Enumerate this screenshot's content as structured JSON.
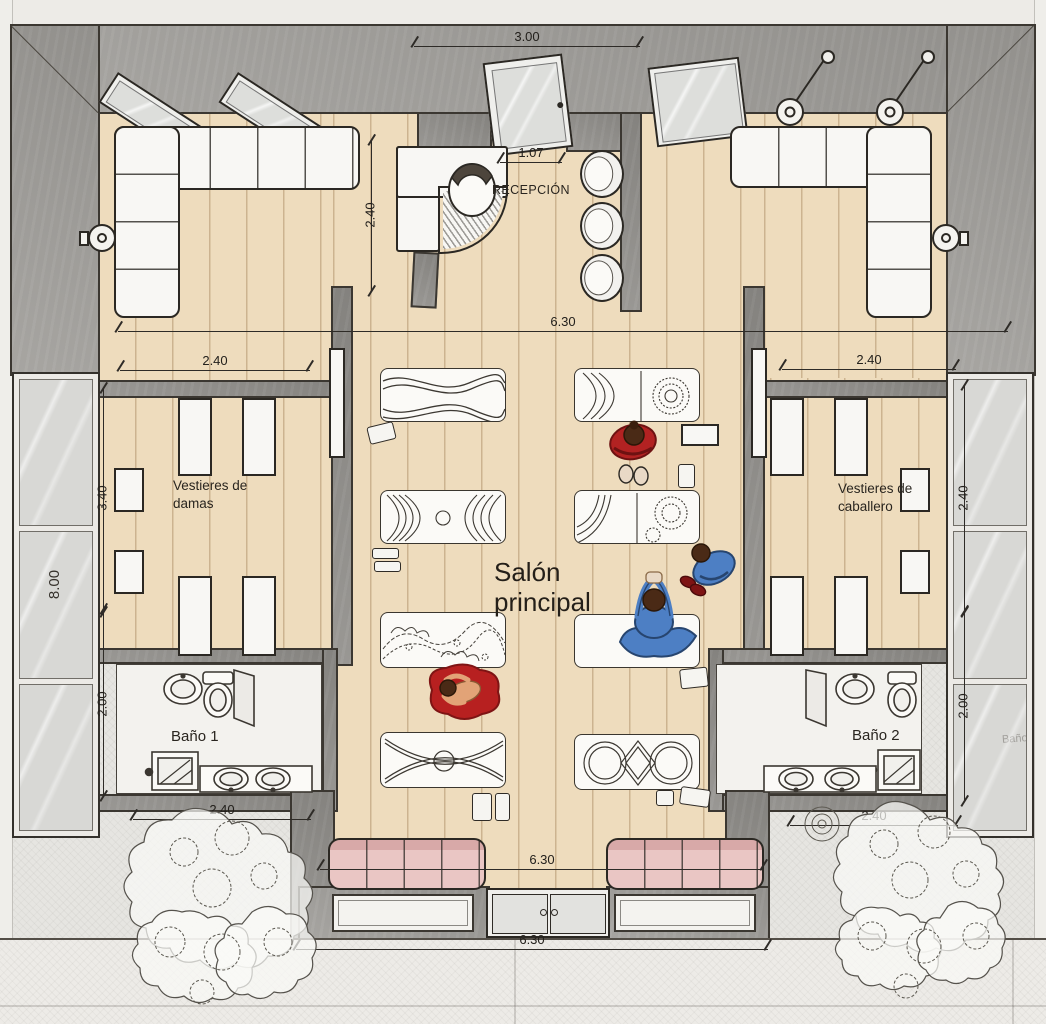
{
  "drawing": {
    "type": "architectural floor plan, top view (yoga / spa studio)",
    "labels": {
      "reception": "RECEPCIÓN",
      "main_hall": "Salón principal",
      "dressing_women": "Vestieres de damas",
      "dressing_men": "Vestieres de caballero",
      "bath_1": "Baño 1",
      "bath_2": "Baño 2",
      "glass_reflection": "Baño"
    },
    "dimensions": [
      {
        "id": "top-entrance-width",
        "value": "3.00",
        "orientation": "horizontal"
      },
      {
        "id": "reception-opening",
        "value": "1.07",
        "orientation": "horizontal"
      },
      {
        "id": "reception-depth",
        "value": "2.40",
        "orientation": "vertical"
      },
      {
        "id": "hall-width-upper",
        "value": "6.30",
        "orientation": "horizontal"
      },
      {
        "id": "dressing-women-width",
        "value": "2.40",
        "orientation": "horizontal"
      },
      {
        "id": "dressing-men-width",
        "value": "2.40",
        "orientation": "horizontal"
      },
      {
        "id": "left-wing-depth",
        "value": "3.40",
        "orientation": "vertical"
      },
      {
        "id": "glass-wall-length",
        "value": "8.00",
        "orientation": "vertical"
      },
      {
        "id": "bath1-depth",
        "value": "2.00",
        "orientation": "vertical"
      },
      {
        "id": "right-wing-depth",
        "value": "2.40",
        "orientation": "vertical"
      },
      {
        "id": "bath2-depth",
        "value": "2.00",
        "orientation": "vertical"
      },
      {
        "id": "bath1-width",
        "value": "2.40",
        "orientation": "horizontal"
      },
      {
        "id": "bath2-width",
        "value": "2.40",
        "orientation": "horizontal"
      },
      {
        "id": "hall-width-lower",
        "value": "6.30",
        "orientation": "horizontal"
      },
      {
        "id": "terrace-width",
        "value": "6.30",
        "orientation": "horizontal"
      }
    ],
    "figures": [
      {
        "pose": "standing arms crossed",
        "outfit": "red",
        "location": "main hall upper right"
      },
      {
        "pose": "kneeling",
        "outfit": "blue",
        "location": "main hall right"
      },
      {
        "pose": "seated arms overhead",
        "outfit": "blue",
        "location": "main hall center on white mat"
      },
      {
        "pose": "lying on round mat",
        "outfit": "red mat",
        "location": "main hall lower left"
      },
      {
        "pose": "seated at desk",
        "outfit": "white",
        "location": "reception"
      }
    ],
    "mats": [
      {
        "col": 1,
        "row": 1,
        "pattern": "waves"
      },
      {
        "col": 1,
        "row": 2,
        "pattern": "feather-chevron"
      },
      {
        "col": 1,
        "row": 3,
        "pattern": "floral-sketch"
      },
      {
        "col": 1,
        "row": 4,
        "pattern": "cross-eye"
      },
      {
        "col": 2,
        "row": 1,
        "pattern": "chevron-mandala"
      },
      {
        "col": 2,
        "row": 2,
        "pattern": "fan-mandala"
      },
      {
        "col": 2,
        "row": 3,
        "pattern": "plain-white"
      },
      {
        "col": 2,
        "row": 4,
        "pattern": "interlocking-rings"
      }
    ],
    "palette": {
      "wall_gray": "#9d9b97",
      "floor_wood": "#eedcbd",
      "plank_line": "#96714a",
      "exterior_paving": "#e6e5e1",
      "glass": "#d8d8d5",
      "furniture_white": "#f8f7f4",
      "sofa_pink": "#eac6c4",
      "outfit_red": "#b22222",
      "outfit_blue": "#4d7fc4",
      "skin": "#e2a377",
      "ink_line": "#2e2b27"
    }
  }
}
